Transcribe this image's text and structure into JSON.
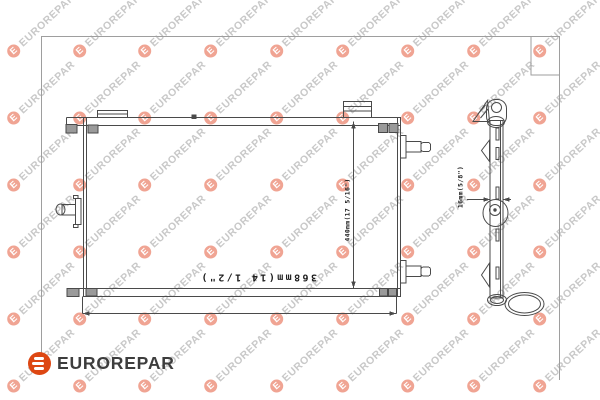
{
  "brand": {
    "name": "EUROREPAR"
  },
  "watermark": {
    "text": "EUROREPAR"
  },
  "diagram": {
    "type": "technical-line-drawing",
    "subject": "condenser-radiator-front-and-side-view",
    "dimensions": {
      "width": "368mm(14 1/2\")",
      "height": "440mm(17 5/16\")",
      "depth": "16mm(5/8\")"
    }
  },
  "colors": {
    "brand_orange": "#dd4713",
    "watermark_pink": "#f0a493",
    "watermark_gray": "#c8c8c8",
    "line_dark": "#4a4a4a",
    "frame_gray": "#9e9e9e",
    "label_ink": "#1c1c1c"
  }
}
